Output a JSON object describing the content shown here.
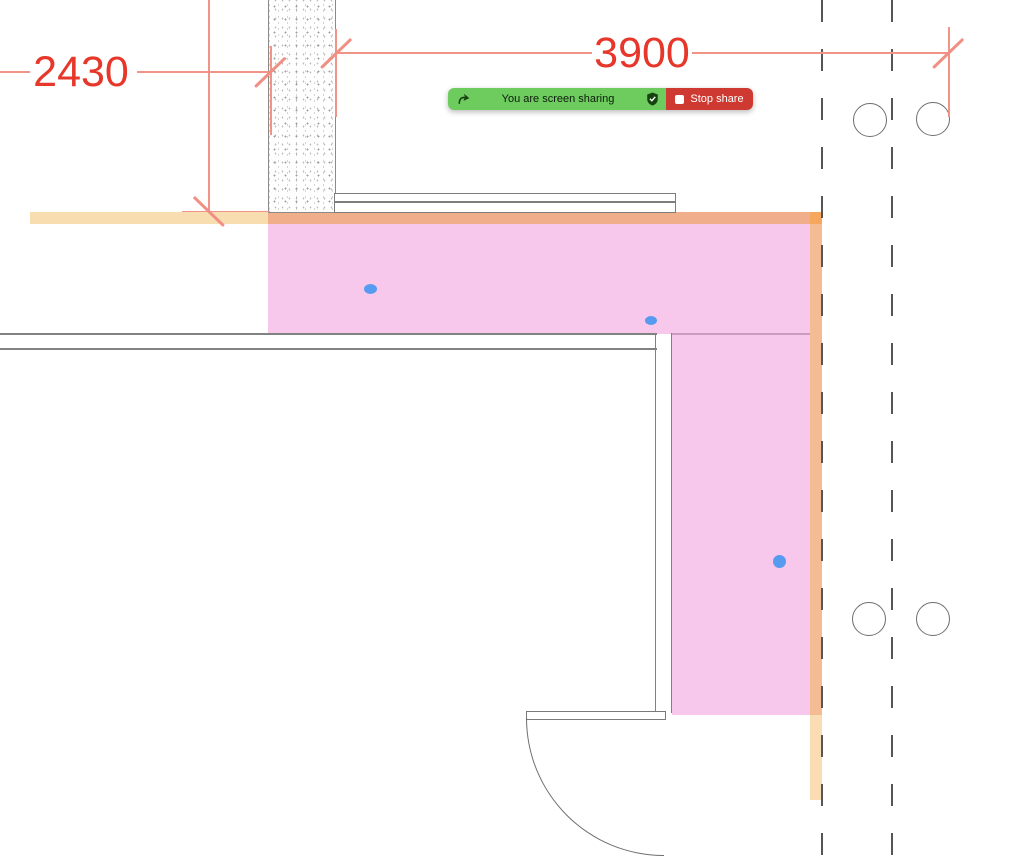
{
  "share_bar": {
    "status_text": "You are screen sharing",
    "stop_share_label": "Stop share",
    "colors": {
      "green": "#6ecb5e",
      "red": "#ce3a31",
      "icon_dark_green": "#17430e"
    },
    "icons": {
      "left": "screen-share-phone-icon",
      "privacy": "shield-check-icon",
      "stop": "stop-square-icon"
    }
  },
  "drawing": {
    "type": "architectural-floor-plan",
    "dimensions": [
      {
        "id": "left-wall-offset",
        "label": "2430"
      },
      {
        "id": "top-span",
        "label": "3900"
      }
    ],
    "colors": {
      "dimension_text": "#e6372a",
      "dimension_line": "#f29388",
      "highlight_pink": "#f8c7ec",
      "band_peach_light": "#f8ddb0",
      "band_orange": "#f1ae8a",
      "band_orange_corner": "#f6a75e",
      "band_orange_vertical": "#f3bc92",
      "band_peach_lower": "#fbddb5",
      "marker_blue": "#569bf0",
      "wall_line_grey": "#828282"
    },
    "markers": [
      "blue-dot",
      "blue-dot",
      "blue-dot"
    ],
    "elements": [
      "hatched-wall",
      "window",
      "interior-wall",
      "door-leaf",
      "door-swing-arc",
      "grid-dashed-lines",
      "column-circles"
    ]
  }
}
